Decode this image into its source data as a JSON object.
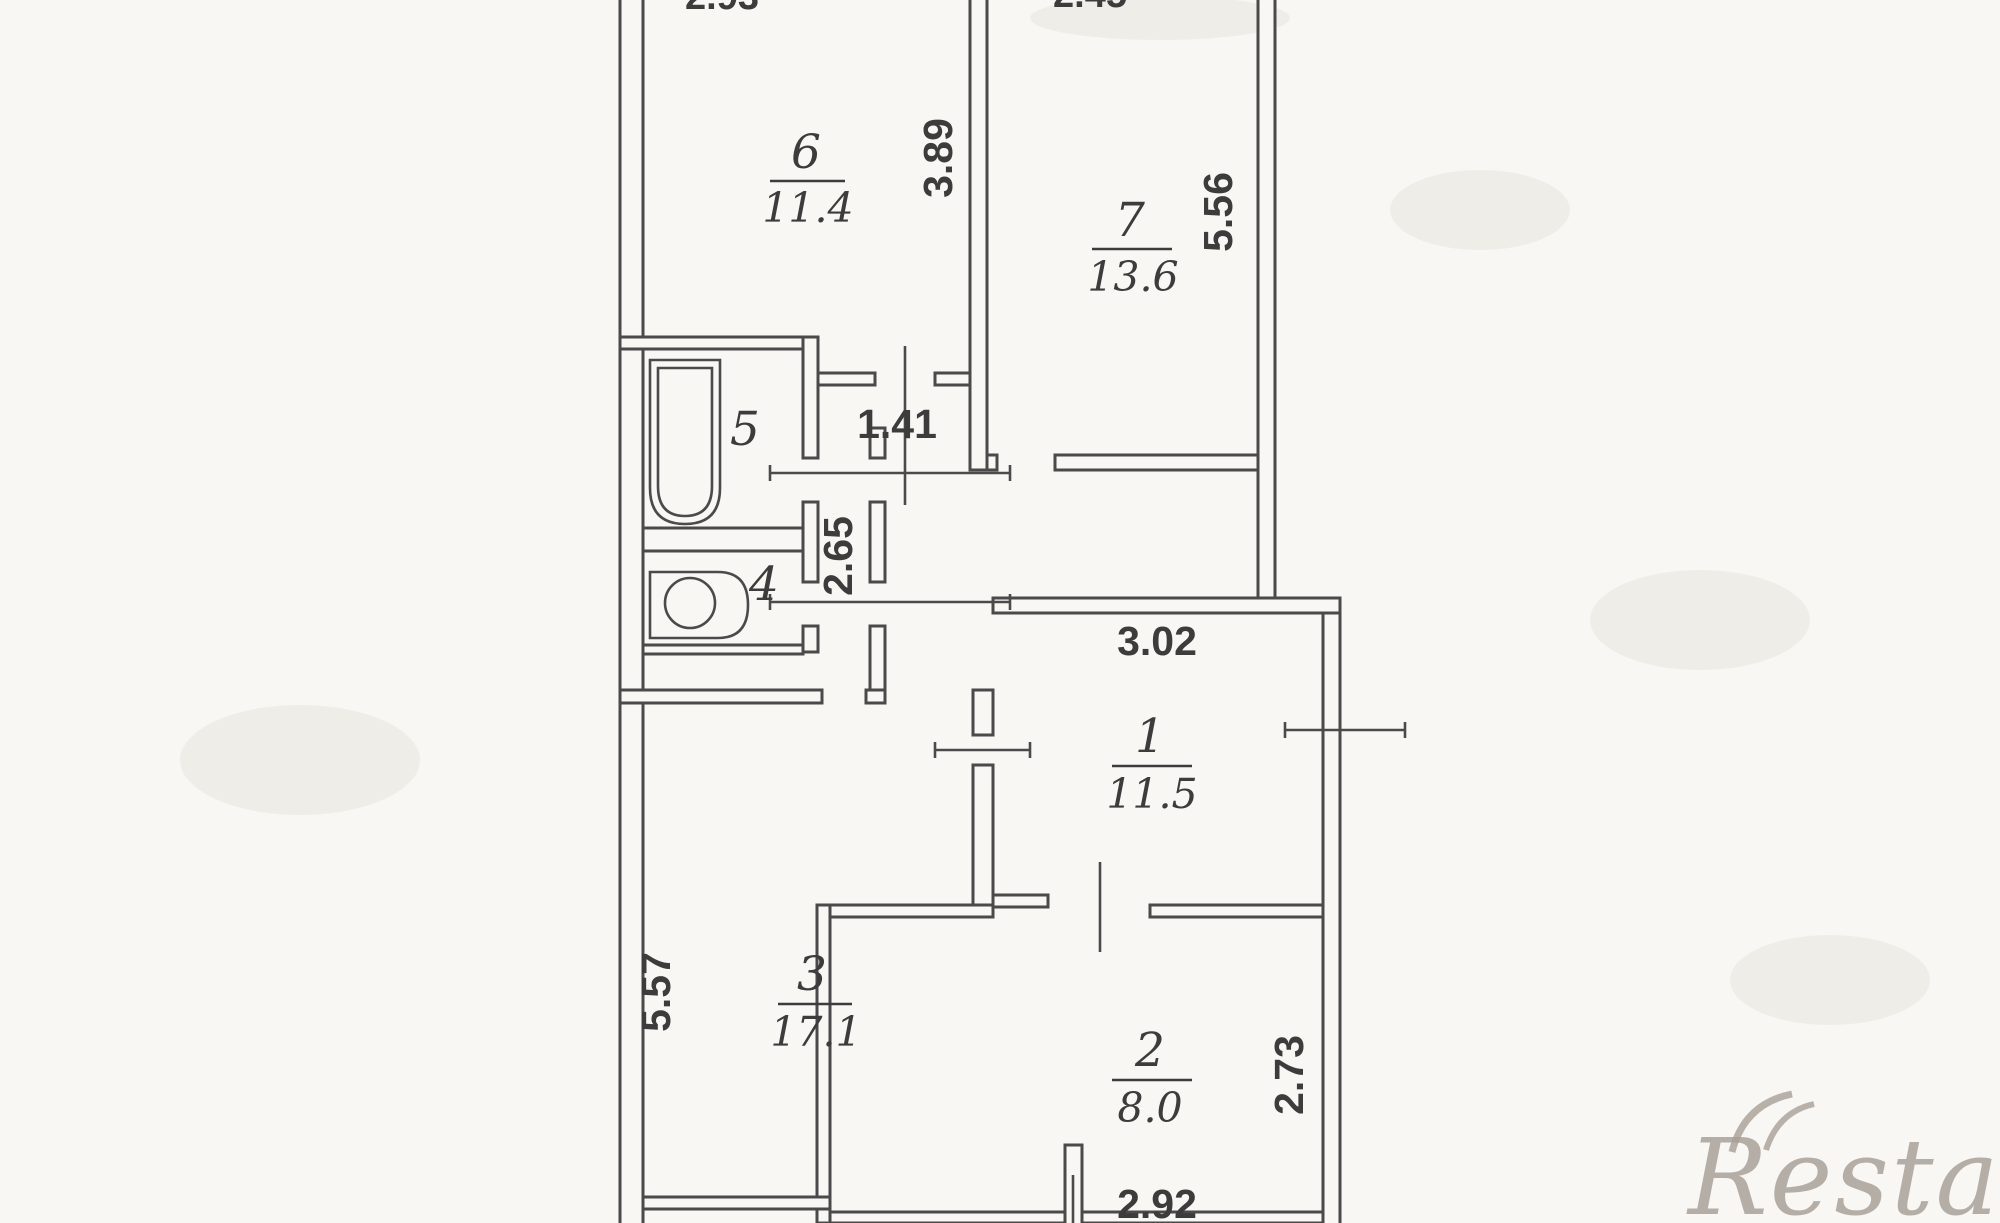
{
  "plan": {
    "rooms": [
      {
        "number": "6",
        "area": "11.4"
      },
      {
        "number": "7",
        "area": "13.6"
      },
      {
        "number": "5",
        "area": ""
      },
      {
        "number": "4",
        "area": ""
      },
      {
        "number": "1",
        "area": "11.5"
      },
      {
        "number": "3",
        "area": "17.1"
      },
      {
        "number": "2",
        "area": "8.0"
      }
    ],
    "dimensions": {
      "room6_depth": "3.89",
      "room7_depth": "5.56",
      "nook_width": "1.41",
      "corridor_depth": "2.65",
      "hall_width": "3.02",
      "room3_depth": "5.57",
      "room2_depth": "2.73",
      "room2_width": "2.92",
      "top_left_partial": "2.93",
      "top_right_partial": "2.45"
    },
    "watermark": "Restate",
    "colors": {
      "line": "#4a4a4a",
      "text": "#3c3c3c",
      "paper": "#f8f7f4",
      "watermark": "#a69f97"
    }
  }
}
